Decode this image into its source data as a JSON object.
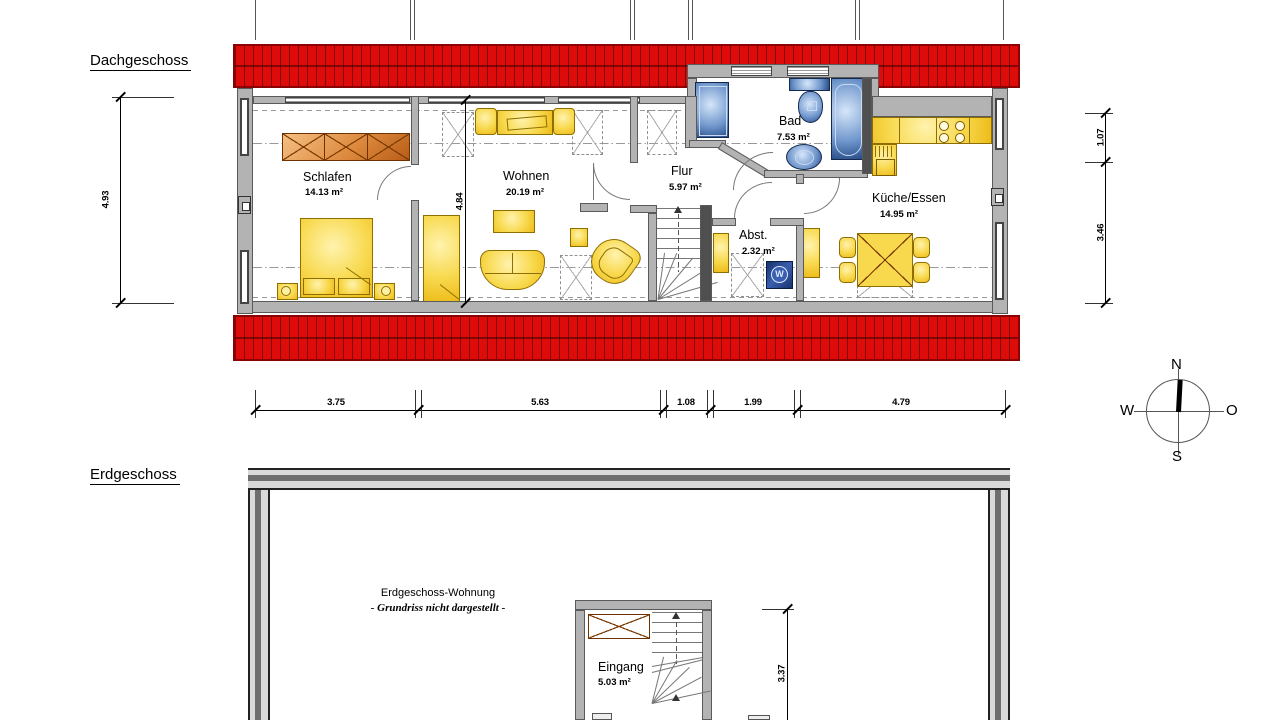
{
  "dg": {
    "title": "Dachgeschoss",
    "rooms": {
      "schlafen": {
        "name": "Schlafen",
        "area": "14.13 m²"
      },
      "wohnen": {
        "name": "Wohnen",
        "area": "20.19 m²"
      },
      "flur": {
        "name": "Flur",
        "area": "5.97 m²"
      },
      "bad": {
        "name": "Bad",
        "area": "7.53 m²"
      },
      "abst": {
        "name": "Abst.",
        "area": "2.32 m²"
      },
      "kueche": {
        "name": "Küche/Essen",
        "area": "14.95 m²"
      }
    },
    "dims": {
      "left": "4.93",
      "inner": "4.84",
      "right_top": "1.07",
      "right_bottom": "3.46",
      "bottom": [
        "3.75",
        "5.63",
        "1.08",
        "1.99",
        "4.79"
      ]
    }
  },
  "eg": {
    "title": "Erdgeschoss",
    "note1": "Erdgeschoss-Wohnung",
    "note2": "- Grundriss nicht dargestellt -",
    "rooms": {
      "eingang": {
        "name": "Eingang",
        "area": "5.03 m²"
      }
    },
    "dims": {
      "stair": "3.37"
    }
  },
  "compass": {
    "n": "N",
    "e": "O",
    "s": "S",
    "w": "W"
  },
  "washer": {
    "label": "W"
  },
  "colors": {
    "roof_red": "#de0b0b",
    "wall_gray": "#b3b3b3",
    "furniture_yellow": "#f2c51f",
    "fixture_blue": "#34518f",
    "wood_orange": "#d47a33"
  }
}
